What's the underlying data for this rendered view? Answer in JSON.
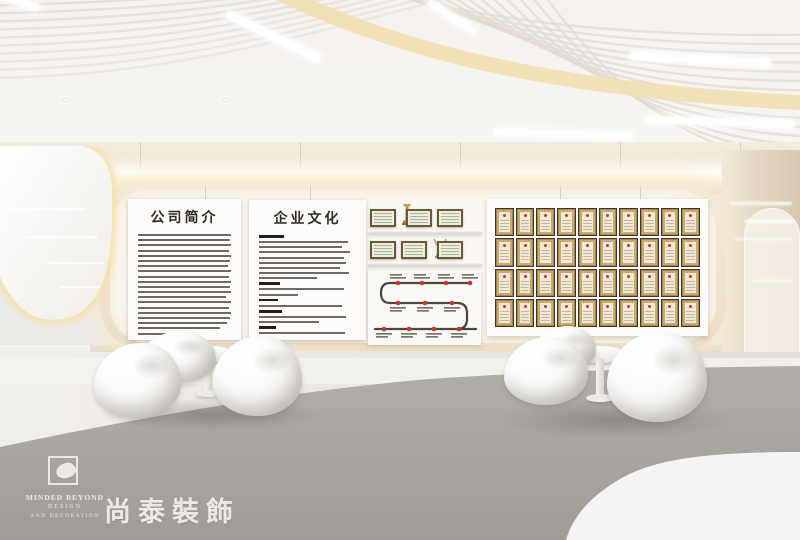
{
  "feature_wall": {
    "intro_panel": {
      "title": "公司简介"
    },
    "culture_panel": {
      "title": "企业文化"
    },
    "honor_shelves": {
      "rows": [
        {
          "items": [
            "certificate-frame",
            "gold-trophy",
            "certificate-frame",
            "certificate-frame"
          ]
        },
        {
          "items": [
            "certificate-frame",
            "certificate-frame",
            "silver-trophy",
            "certificate-frame"
          ]
        }
      ]
    },
    "timeline": {
      "milestones_per_row": [
        4,
        3,
        4
      ]
    },
    "certificate_wall": {
      "rows": 4,
      "columns": 10
    }
  },
  "branding": {
    "logo_en": "MINDED BEYOND",
    "logo_line2": "DESIGN",
    "logo_line3": "AND DECORATION",
    "logo_cn": "尚泰裝飾"
  },
  "palette": {
    "ceiling": "#f5f2ee",
    "rib": "#e1dbd1",
    "accent-band": "#f1dfb2",
    "wall-cream": "#ece1cd",
    "niche-frame": "#f1e8d7",
    "inner-wall": "#faf7f2",
    "panel-white": "#fdfcfa",
    "text-dark": "#2f2c28",
    "floor-gray": "#a7a39c",
    "floor-white": "#f3f2ef",
    "glow": "#f8e7bd",
    "milestone-red": "#cd3527",
    "frame-bronze": "#6a5839",
    "frame-gold": "#a8854e",
    "cert-cream": "#f1e9d6",
    "logo-white": "#ebe9e5"
  }
}
